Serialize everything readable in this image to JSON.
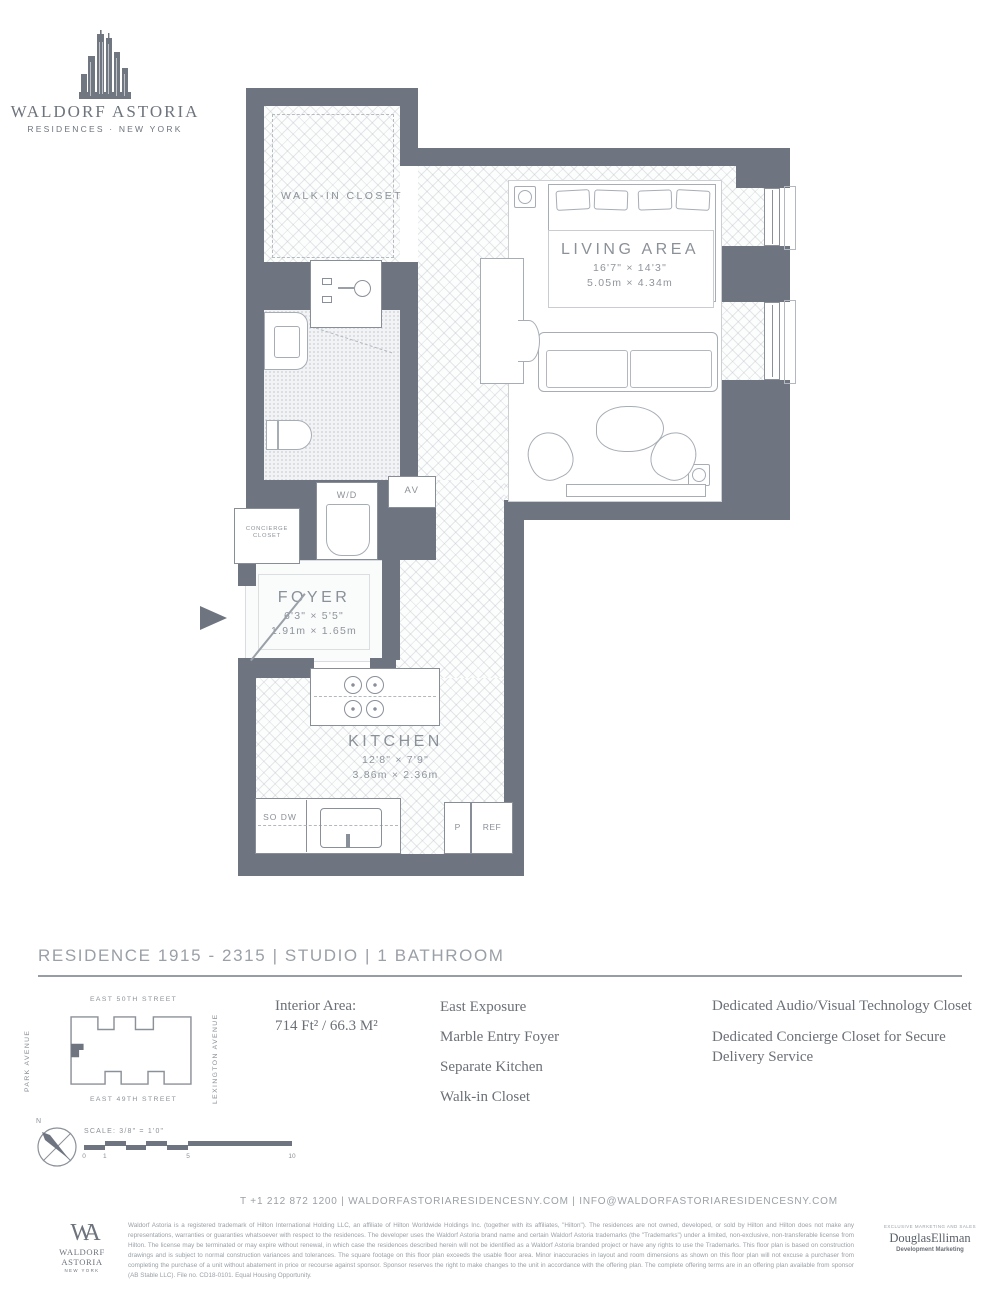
{
  "brand": {
    "name": "WALDORF ASTORIA",
    "subtitle": "RESIDENCES · NEW YORK"
  },
  "floorplan": {
    "walk_in_closet": {
      "label": "WALK-IN CLOSET"
    },
    "living_area": {
      "label": "LIVING AREA",
      "dims_ft": "16'7\" × 14'3\"",
      "dims_m": "5.05m × 4.34m"
    },
    "foyer": {
      "label": "FOYER",
      "dims_ft": "6'3\" × 5'5\"",
      "dims_m": "1.91m × 1.65m"
    },
    "kitchen": {
      "label": "KITCHEN",
      "dims_ft": "12'8\" × 7'9\"",
      "dims_m": "3.86m × 2.36m"
    },
    "concierge_closet": {
      "label": "CONCIERGE CLOSET"
    },
    "wd": {
      "label": "W/D"
    },
    "av": {
      "label": "AV"
    },
    "so_dw": {
      "label": "SO DW"
    },
    "pantry": {
      "label": "P"
    },
    "ref": {
      "label": "REF"
    }
  },
  "residence": {
    "title": "RESIDENCE 1915 - 2315 | STUDIO | 1 BATHROOM"
  },
  "sitemap": {
    "street_top": "EAST 50TH STREET",
    "street_bottom": "EAST 49TH STREET",
    "avenue_left": "PARK AVENUE",
    "avenue_right": "LEXINGTON AVENUE"
  },
  "details": {
    "interior_area_label": "Interior Area:",
    "interior_area_value": "714 Ft² / 66.3 M²",
    "features": [
      "East Exposure",
      "Marble Entry Foyer",
      "Separate Kitchen",
      "Walk-in Closet"
    ],
    "features_right": [
      "Dedicated Audio/Visual Technology Closet",
      "Dedicated Concierge Closet for Secure Delivery Service"
    ]
  },
  "scale": {
    "north_label": "N",
    "label": "SCALE: 3/8\" = 1'0\"",
    "ticks": [
      "0",
      "1",
      "5",
      "10"
    ]
  },
  "contact": {
    "line": "T +1 212 872 1200  |  WALDORFASTORIARESIDENCESNY.COM  |  INFO@WALDORFASTORIARESIDENCESNY.COM"
  },
  "footer": {
    "monogram": "WA",
    "brand": "WALDORF ASTORIA",
    "brand_sub": "NEW YORK",
    "disclaimer": "Waldorf Astoria is a registered trademark of Hilton International Holding LLC, an affiliate of Hilton Worldwide Holdings Inc. (together with its affiliates, \"Hilton\"). The residences are not owned, developed, or sold by Hilton and Hilton does not make any representations, warranties or guaranties whatsoever with respect to the residences. The developer uses the Waldorf Astoria brand name and certain Waldorf Astoria trademarks (the \"Trademarks\") under a limited, non-exclusive, non-transferable license from Hilton. The license may be terminated or may expire without renewal, in which case the residences described herein will not be identified as a Waldorf Astoria branded project or have any rights to use the Trademarks. This floor plan is based on construction drawings and is subject to normal construction variances and tolerances. The square footage on this floor plan exceeds the usable floor area. Minor inaccuracies in layout and room dimensions as shown on this floor plan will not excuse a purchaser from completing the purchase of a unit without abatement in price or recourse against sponsor. Sponsor reserves the right to make changes to the unit in accordance with the offering plan. The complete offering terms are in an offering plan available from sponsor (AB Stable LLC). File no. CD18-0101. Equal Housing Opportunity.",
    "marketing_label": "EXCLUSIVE MARKETING AND SALES",
    "marketing_brand": "DouglasElliman",
    "marketing_sub": "Development Marketing"
  }
}
